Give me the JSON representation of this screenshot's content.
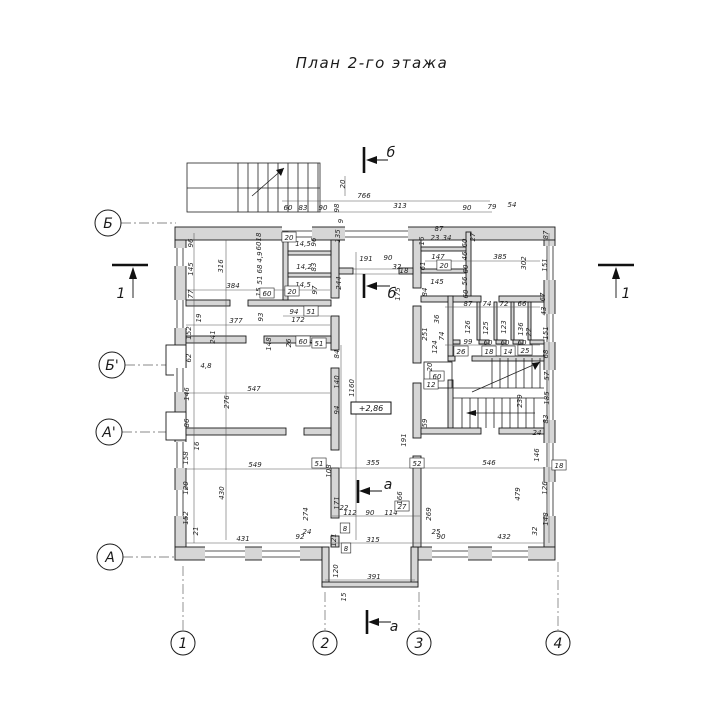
{
  "title": "План 2-го этажа",
  "elevation": "+2,86",
  "axes": {
    "left": [
      {
        "label": "Б"
      },
      {
        "label": "Б'"
      },
      {
        "label": "А'"
      },
      {
        "label": "А"
      }
    ],
    "bottom": [
      {
        "label": "1"
      },
      {
        "label": "2"
      },
      {
        "label": "3"
      },
      {
        "label": "4"
      }
    ]
  },
  "sections": [
    {
      "label": "б"
    },
    {
      "label": "б"
    },
    {
      "label": "а"
    },
    {
      "label": "а"
    },
    {
      "label": "1"
    },
    {
      "label": "1"
    }
  ],
  "dimensions": [
    {
      "t": "20",
      "x": 345,
      "y": 184,
      "r": 1
    },
    {
      "t": "766",
      "x": 364,
      "y": 198
    },
    {
      "t": "60",
      "x": 288,
      "y": 210
    },
    {
      "t": "83",
      "x": 303,
      "y": 210
    },
    {
      "t": "90",
      "x": 323,
      "y": 210
    },
    {
      "t": "98",
      "x": 339,
      "y": 208,
      "r": 1
    },
    {
      "t": "313",
      "x": 400,
      "y": 208
    },
    {
      "t": "90",
      "x": 467,
      "y": 210
    },
    {
      "t": "79",
      "x": 492,
      "y": 209
    },
    {
      "t": "54",
      "x": 512,
      "y": 207
    },
    {
      "t": "96",
      "x": 193,
      "y": 243,
      "r": 1
    },
    {
      "t": "145",
      "x": 193,
      "y": 269,
      "r": 1
    },
    {
      "t": "77",
      "x": 193,
      "y": 294,
      "r": 1
    },
    {
      "t": "19",
      "x": 201,
      "y": 318,
      "r": 1
    },
    {
      "t": "152",
      "x": 191,
      "y": 333,
      "r": 1
    },
    {
      "t": "62",
      "x": 191,
      "y": 358,
      "r": 1
    },
    {
      "t": "4,8",
      "x": 206,
      "y": 368
    },
    {
      "t": "146",
      "x": 189,
      "y": 394,
      "r": 1
    },
    {
      "t": "86",
      "x": 189,
      "y": 423,
      "r": 1
    },
    {
      "t": "16",
      "x": 199,
      "y": 446,
      "r": 1
    },
    {
      "t": "158",
      "x": 188,
      "y": 458,
      "r": 1
    },
    {
      "t": "120",
      "x": 188,
      "y": 488,
      "r": 1
    },
    {
      "t": "152",
      "x": 188,
      "y": 518,
      "r": 1
    },
    {
      "t": "21",
      "x": 198,
      "y": 531,
      "r": 1
    },
    {
      "t": "316",
      "x": 223,
      "y": 266,
      "r": 1
    },
    {
      "t": "384",
      "x": 233,
      "y": 288
    },
    {
      "t": "241",
      "x": 215,
      "y": 337,
      "r": 1
    },
    {
      "t": "377",
      "x": 236,
      "y": 323
    },
    {
      "t": "547",
      "x": 254,
      "y": 391
    },
    {
      "t": "276",
      "x": 229,
      "y": 402,
      "r": 1
    },
    {
      "t": "549",
      "x": 255,
      "y": 467
    },
    {
      "t": "430",
      "x": 224,
      "y": 493,
      "r": 1
    },
    {
      "t": "431",
      "x": 243,
      "y": 541
    },
    {
      "t": "92",
      "x": 300,
      "y": 539
    },
    {
      "t": "24",
      "x": 307,
      "y": 534
    },
    {
      "t": "274",
      "x": 308,
      "y": 514,
      "r": 1
    },
    {
      "t": "18",
      "x": 261,
      "y": 237,
      "r": 1
    },
    {
      "t": "60",
      "x": 261,
      "y": 246,
      "r": 1
    },
    {
      "t": "4,9",
      "x": 262,
      "y": 257,
      "r": 1
    },
    {
      "t": "68",
      "x": 262,
      "y": 269,
      "r": 1
    },
    {
      "t": "51",
      "x": 262,
      "y": 280,
      "r": 1
    },
    {
      "t": "15",
      "x": 261,
      "y": 292,
      "r": 1
    },
    {
      "t": "60",
      "x": 267,
      "y": 296,
      "box": 1
    },
    {
      "t": "20",
      "x": 289,
      "y": 240,
      "box": 1
    },
    {
      "t": "14,5",
      "x": 303,
      "y": 246
    },
    {
      "t": "96",
      "x": 316,
      "y": 242,
      "r": 1
    },
    {
      "t": "14,2",
      "x": 304,
      "y": 269
    },
    {
      "t": "83",
      "x": 316,
      "y": 267,
      "r": 1
    },
    {
      "t": "14,5",
      "x": 303,
      "y": 287
    },
    {
      "t": "97",
      "x": 317,
      "y": 290,
      "r": 1
    },
    {
      "t": "20",
      "x": 292,
      "y": 294,
      "box": 1
    },
    {
      "t": "94",
      "x": 294,
      "y": 314
    },
    {
      "t": "51",
      "x": 311,
      "y": 314,
      "box": 1
    },
    {
      "t": "172",
      "x": 298,
      "y": 322
    },
    {
      "t": "93",
      "x": 263,
      "y": 317,
      "r": 1
    },
    {
      "t": "148",
      "x": 271,
      "y": 344,
      "r": 1
    },
    {
      "t": "26",
      "x": 291,
      "y": 343,
      "r": 1
    },
    {
      "t": "60",
      "x": 303,
      "y": 344,
      "box": 1
    },
    {
      "t": "4,1",
      "x": 315,
      "y": 344
    },
    {
      "t": "9",
      "x": 343,
      "y": 221,
      "r": 1
    },
    {
      "t": "135",
      "x": 340,
      "y": 236,
      "r": 1
    },
    {
      "t": "244",
      "x": 341,
      "y": 283,
      "r": 1
    },
    {
      "t": "191",
      "x": 366,
      "y": 261
    },
    {
      "t": "90",
      "x": 388,
      "y": 260
    },
    {
      "t": "32",
      "x": 397,
      "y": 269
    },
    {
      "t": "18",
      "x": 404,
      "y": 273
    },
    {
      "t": "175",
      "x": 400,
      "y": 294,
      "r": 1
    },
    {
      "t": "1160",
      "x": 354,
      "y": 388,
      "r": 1
    },
    {
      "t": "51",
      "x": 319,
      "y": 346,
      "box": 1
    },
    {
      "t": "84",
      "x": 339,
      "y": 354,
      "r": 1
    },
    {
      "t": "140",
      "x": 339,
      "y": 382,
      "r": 1
    },
    {
      "t": "94",
      "x": 339,
      "y": 410,
      "r": 1
    },
    {
      "t": "191",
      "x": 406,
      "y": 440,
      "r": 1
    },
    {
      "t": "59",
      "x": 427,
      "y": 423,
      "r": 1
    },
    {
      "t": "52",
      "x": 417,
      "y": 466,
      "box": 1
    },
    {
      "t": "51",
      "x": 319,
      "y": 466,
      "box": 1
    },
    {
      "t": "355",
      "x": 373,
      "y": 465
    },
    {
      "t": "546",
      "x": 489,
      "y": 465
    },
    {
      "t": "108",
      "x": 331,
      "y": 471,
      "r": 1
    },
    {
      "t": "171",
      "x": 339,
      "y": 503,
      "r": 1
    },
    {
      "t": "22",
      "x": 344,
      "y": 510
    },
    {
      "t": "112",
      "x": 350,
      "y": 515
    },
    {
      "t": "90",
      "x": 370,
      "y": 515
    },
    {
      "t": "114",
      "x": 391,
      "y": 515
    },
    {
      "t": "27",
      "x": 402,
      "y": 509,
      "box": 1
    },
    {
      "t": "166",
      "x": 402,
      "y": 498,
      "r": 1
    },
    {
      "t": "269",
      "x": 431,
      "y": 514,
      "r": 1
    },
    {
      "t": "25",
      "x": 436,
      "y": 534
    },
    {
      "t": "90",
      "x": 441,
      "y": 539
    },
    {
      "t": "315",
      "x": 373,
      "y": 542
    },
    {
      "t": "8",
      "x": 345,
      "y": 531,
      "box": 1
    },
    {
      "t": "121",
      "x": 336,
      "y": 540,
      "r": 1
    },
    {
      "t": "8",
      "x": 346,
      "y": 551,
      "box": 1
    },
    {
      "t": "120",
      "x": 338,
      "y": 571,
      "r": 1
    },
    {
      "t": "391",
      "x": 374,
      "y": 579
    },
    {
      "t": "15",
      "x": 346,
      "y": 597,
      "r": 1
    },
    {
      "t": "87",
      "x": 439,
      "y": 231
    },
    {
      "t": "23",
      "x": 435,
      "y": 240
    },
    {
      "t": "34",
      "x": 447,
      "y": 240
    },
    {
      "t": "16",
      "x": 424,
      "y": 241,
      "r": 1
    },
    {
      "t": "27",
      "x": 475,
      "y": 237,
      "r": 1
    },
    {
      "t": "60",
      "x": 467,
      "y": 243,
      "r": 1
    },
    {
      "t": "46",
      "x": 467,
      "y": 256,
      "r": 1
    },
    {
      "t": "60",
      "x": 468,
      "y": 269,
      "r": 1
    },
    {
      "t": "56",
      "x": 467,
      "y": 281,
      "r": 1
    },
    {
      "t": "60",
      "x": 468,
      "y": 294,
      "r": 1
    },
    {
      "t": "61",
      "x": 425,
      "y": 266,
      "r": 1
    },
    {
      "t": "84",
      "x": 427,
      "y": 292,
      "r": 1
    },
    {
      "t": "147",
      "x": 438,
      "y": 259
    },
    {
      "t": "20",
      "x": 444,
      "y": 268,
      "box": 1
    },
    {
      "t": "145",
      "x": 437,
      "y": 284
    },
    {
      "t": "385",
      "x": 500,
      "y": 259
    },
    {
      "t": "302",
      "x": 526,
      "y": 263,
      "r": 1
    },
    {
      "t": "87",
      "x": 548,
      "y": 235,
      "r": 1
    },
    {
      "t": "151",
      "x": 547,
      "y": 265,
      "r": 1
    },
    {
      "t": "67",
      "x": 545,
      "y": 297,
      "r": 1
    },
    {
      "t": "43",
      "x": 546,
      "y": 311,
      "r": 1
    },
    {
      "t": "151",
      "x": 548,
      "y": 333,
      "r": 1
    },
    {
      "t": "68",
      "x": 548,
      "y": 354,
      "r": 1
    },
    {
      "t": "57",
      "x": 549,
      "y": 376,
      "r": 1
    },
    {
      "t": "185",
      "x": 549,
      "y": 398,
      "r": 1
    },
    {
      "t": "83",
      "x": 548,
      "y": 419,
      "r": 1
    },
    {
      "t": "24",
      "x": 537,
      "y": 435
    },
    {
      "t": "146",
      "x": 539,
      "y": 455,
      "r": 1
    },
    {
      "t": "18",
      "x": 559,
      "y": 468,
      "box": 1
    },
    {
      "t": "126",
      "x": 547,
      "y": 488,
      "r": 1
    },
    {
      "t": "148",
      "x": 548,
      "y": 519,
      "r": 1
    },
    {
      "t": "32",
      "x": 537,
      "y": 531,
      "r": 1
    },
    {
      "t": "87",
      "x": 468,
      "y": 306
    },
    {
      "t": "74",
      "x": 487,
      "y": 306
    },
    {
      "t": "72",
      "x": 504,
      "y": 306
    },
    {
      "t": "66",
      "x": 522,
      "y": 306
    },
    {
      "t": "126",
      "x": 470,
      "y": 327,
      "r": 1
    },
    {
      "t": "125",
      "x": 488,
      "y": 328,
      "r": 1
    },
    {
      "t": "123",
      "x": 506,
      "y": 327,
      "r": 1
    },
    {
      "t": "136",
      "x": 523,
      "y": 329,
      "r": 1
    },
    {
      "t": "22",
      "x": 531,
      "y": 332,
      "r": 1
    },
    {
      "t": "99",
      "x": 468,
      "y": 344
    },
    {
      "t": "60",
      "x": 488,
      "y": 345
    },
    {
      "t": "60",
      "x": 505,
      "y": 345
    },
    {
      "t": "60",
      "x": 522,
      "y": 345
    },
    {
      "t": "26",
      "x": 461,
      "y": 354,
      "box": 1
    },
    {
      "t": "18",
      "x": 489,
      "y": 354,
      "box": 1
    },
    {
      "t": "14",
      "x": 508,
      "y": 354,
      "box": 1
    },
    {
      "t": "25",
      "x": 525,
      "y": 353,
      "box": 1
    },
    {
      "t": "251",
      "x": 427,
      "y": 334,
      "r": 1
    },
    {
      "t": "124",
      "x": 437,
      "y": 347,
      "r": 1
    },
    {
      "t": "74",
      "x": 444,
      "y": 336,
      "r": 1
    },
    {
      "t": "36",
      "x": 439,
      "y": 319,
      "r": 1
    },
    {
      "t": "20",
      "x": 432,
      "y": 367,
      "r": 1
    },
    {
      "t": "60",
      "x": 437,
      "y": 379,
      "box": 1
    },
    {
      "t": "12",
      "x": 431,
      "y": 387,
      "box": 1
    },
    {
      "t": "239",
      "x": 522,
      "y": 401,
      "r": 1
    },
    {
      "t": "479",
      "x": 520,
      "y": 494,
      "r": 1
    },
    {
      "t": "432",
      "x": 504,
      "y": 539
    }
  ]
}
